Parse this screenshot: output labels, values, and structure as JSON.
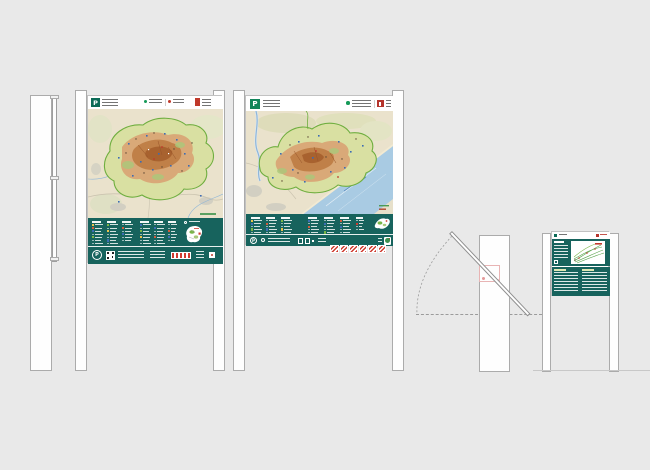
{
  "canvas": {
    "width": 650,
    "height": 470,
    "background": "#e9e9e9"
  },
  "palette": {
    "teal_band": "#17635d",
    "post_white": "#fefefe",
    "post_border": "#ababab",
    "map_beige": "#eae2cc",
    "park_boundary_green": "#6fae3f",
    "park_fill": "#d9e0a2",
    "terrain_orange": "#d9a978",
    "terrain_dark": "#c08048",
    "sea_blue": "#a9cbe3",
    "accent_red": "#c0392b",
    "logo_green_dark": "#0c6b57",
    "logo_green": "#12855a",
    "pivot_pink": "#e8a8a8"
  },
  "side_view_large": {
    "bracket_count": 3
  },
  "sign_a": {
    "header": {
      "park_logo_letter": "P"
    },
    "legend": {
      "row_h": 3.1,
      "columns": [
        {
          "x": 4,
          "w": 12,
          "lines": 7,
          "chips": [
            "#e6c44d",
            "#cf5b3c",
            "#3c6cb4",
            null,
            "#7ab648",
            null,
            null
          ]
        },
        {
          "x": 19,
          "w": 12,
          "lines": 7,
          "chips": [
            "#7ab648",
            null,
            "#e6c44d",
            null,
            null,
            "#3c6cb4",
            null
          ]
        },
        {
          "x": 34,
          "w": 12,
          "lines": 6,
          "chips": [
            null,
            "#cf5b3c",
            null,
            "#3c6cb4",
            null,
            null
          ]
        },
        {
          "x": 52,
          "w": 12,
          "lines": 7,
          "chips": [
            "#3c6cb4",
            null,
            "#7ab648",
            null,
            "#e6c44d",
            null,
            null
          ]
        },
        {
          "x": 66,
          "w": 12,
          "lines": 7,
          "chips": [
            null,
            "#3c6cb4",
            null,
            null,
            "#cf5b3c",
            null,
            null
          ]
        },
        {
          "x": 80,
          "w": 10,
          "lines": 6,
          "chips": [
            null,
            null,
            "#cf5b3c",
            null,
            "#3c6cb4",
            null
          ]
        }
      ]
    },
    "footer": {
      "circle_letter": "P"
    }
  },
  "sign_b": {
    "header": {
      "park_logo_letter": "P"
    },
    "legend": {
      "row_h": 2.9,
      "columns": [
        {
          "x": 5,
          "w": 12,
          "lines": 5,
          "chips": [
            "#e6c44d",
            "#3c6cb4",
            null,
            "#7ab648",
            null
          ]
        },
        {
          "x": 20,
          "w": 12,
          "lines": 5,
          "chips": [
            null,
            "#cf5b3c",
            null,
            "#3c6cb4",
            null
          ]
        },
        {
          "x": 35,
          "w": 12,
          "lines": 5,
          "chips": [
            "#7ab648",
            null,
            null,
            "#e6c44d",
            null
          ]
        },
        {
          "x": 62,
          "w": 12,
          "lines": 5,
          "chips": [
            "#3c6cb4",
            null,
            "#cf5b3c",
            null,
            null
          ]
        },
        {
          "x": 78,
          "w": 12,
          "lines": 5,
          "chips": [
            null,
            "#3c6cb4",
            null,
            null,
            "#7ab648"
          ]
        },
        {
          "x": 94,
          "w": 12,
          "lines": 5,
          "chips": [
            "#cf5b3c",
            null,
            "#3c6cb4",
            null,
            null
          ]
        },
        {
          "x": 110,
          "w": 9,
          "lines": 4,
          "chips": [
            null,
            "#cf3b2f",
            null,
            null
          ]
        }
      ]
    },
    "footer": {
      "flag_count": 6,
      "circle_letter": "P"
    }
  },
  "small_sign": {},
  "tilt_diagram": {}
}
